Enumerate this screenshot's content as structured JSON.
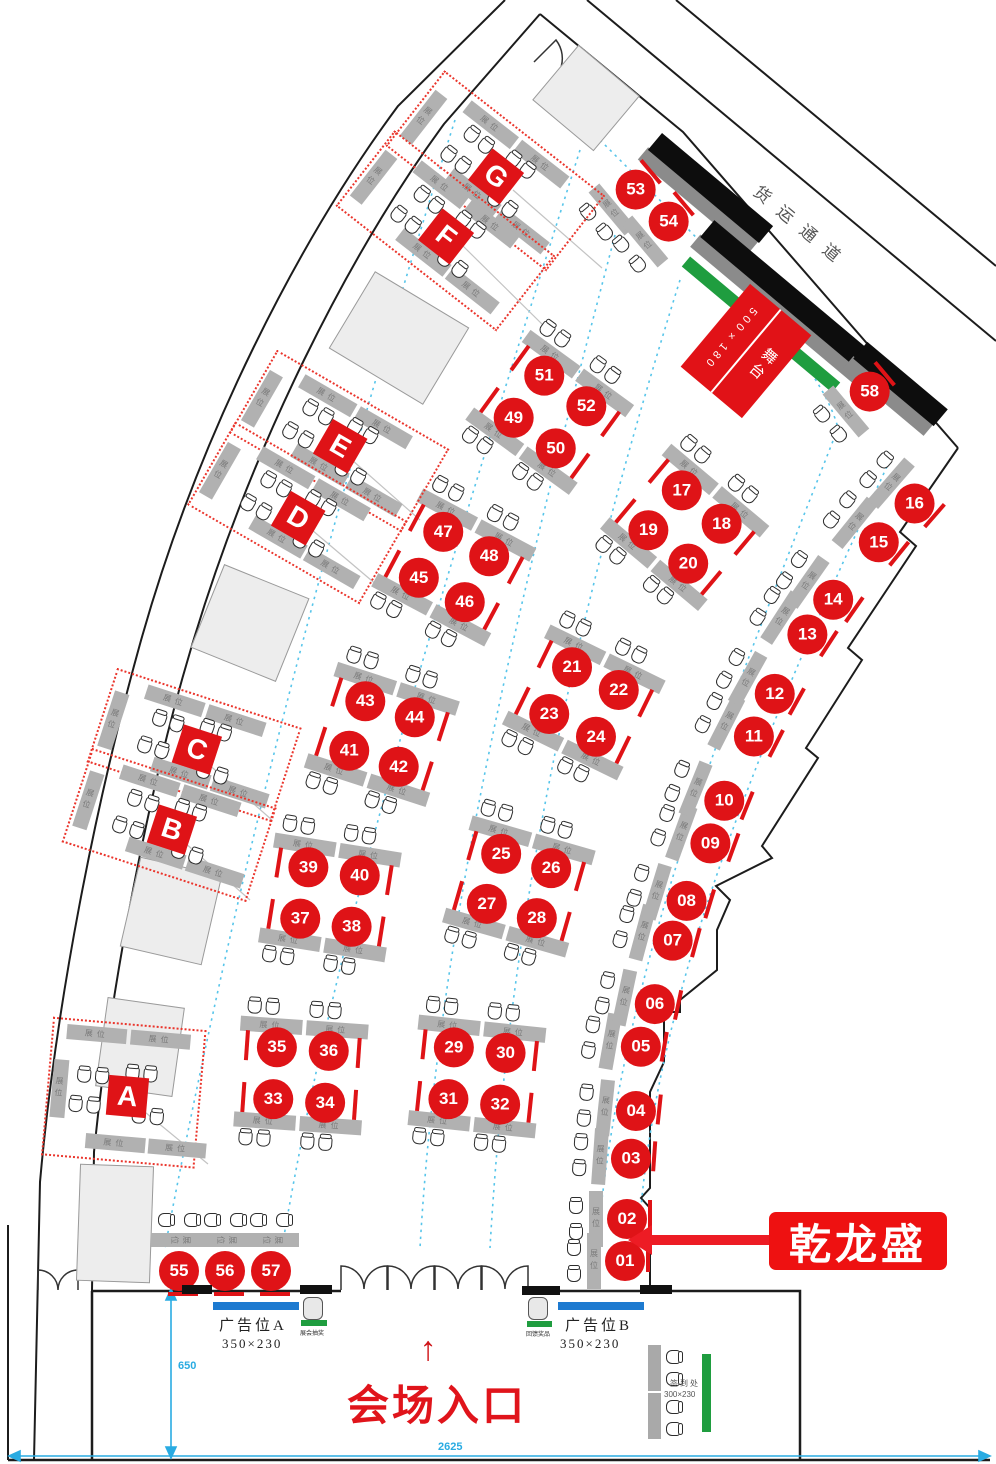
{
  "labels": {
    "freight": "货运通道",
    "stage": "舞台",
    "stage_size": "500×180",
    "entrance": "会场入口",
    "arrow_up": "↑",
    "callout": "乾龙盛",
    "strip": "展位",
    "ad_a": "广告位A",
    "ad_a_size": "350×230",
    "ad_b": "广告位B",
    "ad_b_size": "350×230",
    "signin": "签到处",
    "signin_size": "300×230",
    "note_a": "展会抽奖",
    "note_b": "回馈奖品",
    "dim_v": "650",
    "dim_h": "2625"
  },
  "colors": {
    "booth_red": "#df1317",
    "callout_red": "#ee1111",
    "green": "#1f9d3f",
    "ad_blue": "#1d7ad0",
    "dim_blue": "#29abe2",
    "aisle_blue": "#57c5ea"
  },
  "letter_areas": [
    {
      "label": "G",
      "x": 495,
      "y": 168,
      "rot": 38,
      "w": 200,
      "h": 92
    },
    {
      "label": "F",
      "x": 445,
      "y": 228,
      "rot": 38,
      "w": 200,
      "h": 92
    },
    {
      "label": "E",
      "x": 338,
      "y": 438,
      "rot": 30,
      "w": 195,
      "h": 92
    },
    {
      "label": "D",
      "x": 296,
      "y": 510,
      "rot": 30,
      "w": 195,
      "h": 92
    },
    {
      "label": "C",
      "x": 193,
      "y": 742,
      "rot": 18,
      "w": 190,
      "h": 95
    },
    {
      "label": "B",
      "x": 168,
      "y": 822,
      "rot": 18,
      "w": 190,
      "h": 95
    },
    {
      "label": "A",
      "x": 122,
      "y": 1090,
      "rot": 5,
      "w": 150,
      "h": 135
    }
  ],
  "quad_clusters": [
    {
      "nums": [
        "51",
        "52",
        "49",
        "50"
      ],
      "x": 550,
      "y": 412,
      "rot": 36
    },
    {
      "nums": [
        "47",
        "48",
        "45",
        "46"
      ],
      "x": 454,
      "y": 567,
      "rot": 28
    },
    {
      "nums": [
        "43",
        "44",
        "41",
        "42"
      ],
      "x": 382,
      "y": 734,
      "rot": 18
    },
    {
      "nums": [
        "39",
        "40",
        "37",
        "38"
      ],
      "x": 330,
      "y": 897,
      "rot": 9
    },
    {
      "nums": [
        "35",
        "36",
        "33",
        "34"
      ],
      "x": 301,
      "y": 1075,
      "rot": 4
    },
    {
      "nums": [
        "17",
        "18",
        "19",
        "20"
      ],
      "x": 685,
      "y": 527,
      "rot": 40
    },
    {
      "nums": [
        "21",
        "22",
        "23",
        "24"
      ],
      "x": 584,
      "y": 702,
      "rot": 26
    },
    {
      "nums": [
        "25",
        "26",
        "27",
        "28"
      ],
      "x": 519,
      "y": 886,
      "rot": 16
    },
    {
      "nums": [
        "29",
        "30",
        "31",
        "32"
      ],
      "x": 477,
      "y": 1076,
      "rot": 6
    }
  ],
  "single_booths": [
    {
      "num": "01",
      "x": 615,
      "y": 1261,
      "rot": 0
    },
    {
      "num": "02",
      "x": 617,
      "y": 1219,
      "rot": 0
    },
    {
      "num": "03",
      "x": 621,
      "y": 1158,
      "rot": 4
    },
    {
      "num": "04",
      "x": 626,
      "y": 1110,
      "rot": 6
    },
    {
      "num": "05",
      "x": 631,
      "y": 1045,
      "rot": 10
    },
    {
      "num": "06",
      "x": 645,
      "y": 1002,
      "rot": 12
    },
    {
      "num": "07",
      "x": 663,
      "y": 938,
      "rot": 15
    },
    {
      "num": "08",
      "x": 677,
      "y": 898,
      "rot": 17
    },
    {
      "num": "09",
      "x": 701,
      "y": 840,
      "rot": 20
    },
    {
      "num": "10",
      "x": 715,
      "y": 797,
      "rot": 22
    },
    {
      "num": "11",
      "x": 745,
      "y": 732,
      "rot": 27
    },
    {
      "num": "12",
      "x": 766,
      "y": 689,
      "rot": 29
    },
    {
      "num": "13",
      "x": 799,
      "y": 629,
      "rot": 33
    },
    {
      "num": "14",
      "x": 825,
      "y": 594,
      "rot": 35
    },
    {
      "num": "15",
      "x": 871,
      "y": 536,
      "rot": 39
    },
    {
      "num": "16",
      "x": 907,
      "y": 497,
      "rot": 41
    },
    {
      "num": "53",
      "x": 628,
      "y": 196,
      "rot": -40
    },
    {
      "num": "54",
      "x": 661,
      "y": 228,
      "rot": -40
    },
    {
      "num": "58",
      "x": 862,
      "y": 398,
      "rot": -40
    },
    {
      "num": "55",
      "x": 179,
      "y": 1261,
      "rot": 90
    },
    {
      "num": "56",
      "x": 225,
      "y": 1261,
      "rot": 90
    },
    {
      "num": "57",
      "x": 271,
      "y": 1261,
      "rot": 90
    }
  ]
}
